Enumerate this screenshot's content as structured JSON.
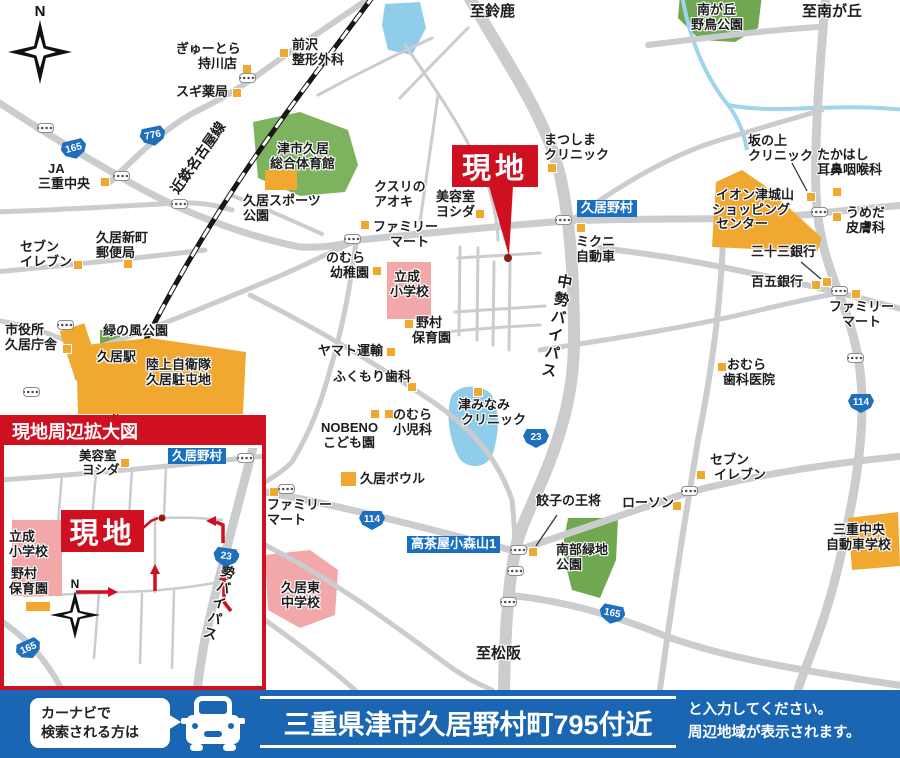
{
  "colors": {
    "site_red": "#cf1021",
    "landmark_orange": "#f0a830",
    "school_pink": "#f2a8a8",
    "park_green": "#6fa850",
    "water_blue": "#8fcdea",
    "road_gray": "#cbccce",
    "label_blue": "#1b6fbf",
    "bar_blue": "#1a66b2",
    "shield_blue": "#1e6fbc"
  },
  "compass": {
    "n": "N"
  },
  "site": {
    "label": "現地"
  },
  "roads": {
    "railway": "近鉄名古屋線",
    "bypass": "中勢バイパス"
  },
  "destinations": {
    "suzuka": "至鈴鹿",
    "minamigaoka": "至南が丘",
    "matsusaka": "至松阪"
  },
  "shields": {
    "r165": "165",
    "r776": "776",
    "r23": "23",
    "r114": "114"
  },
  "intersections": {
    "hisainomura": "久居野村",
    "takachaya": "高茶屋小森山1"
  },
  "places": {
    "gyutora": {
      "l1": "ぎゅーとら",
      "l2": "持川店"
    },
    "sugi": {
      "l1": "スギ薬局"
    },
    "ja": {
      "l1": "JA",
      "l2": "三重中央"
    },
    "maezawa": {
      "l1": "前沢",
      "l2": "整形外科"
    },
    "gym": {
      "l1": "津市久居",
      "l2": "総合体育館"
    },
    "sports_park": {
      "l1": "久居スポーツ",
      "l2": "公園"
    },
    "aoki": {
      "l1": "クスリの",
      "l2": "アオキ"
    },
    "yoshida": {
      "l1": "美容室",
      "l2": "ヨシダ"
    },
    "matsushima": {
      "l1": "まつしま",
      "l2": "クリニック"
    },
    "yacho_park": {
      "l1": "南が丘",
      "l2": "野鳥公園"
    },
    "sakanoue": {
      "l1": "坂の上",
      "l2": "クリニック"
    },
    "takahashi": {
      "l1": "たかはし",
      "l2": "耳鼻咽喉科"
    },
    "aeon": {
      "l1": "イオン津城山",
      "l2": "ショッピング",
      "l3": "センター"
    },
    "umeda": {
      "l1": "うめだ",
      "l2": "皮膚科"
    },
    "sanjusan": {
      "l1": "三十三銀行"
    },
    "hyakugo": {
      "l1": "百五銀行"
    },
    "famima_e": {
      "l1": "ファミリー",
      "l2": "マート"
    },
    "omura": {
      "l1": "おむら",
      "l2": "歯科医院"
    },
    "mikuni": {
      "l1": "ミクニ",
      "l2": "自動車"
    },
    "nomura_hoikuen": {
      "l1": "野村",
      "l2": "保育園"
    },
    "rissei": {
      "l1": "立成",
      "l2": "小学校"
    },
    "yochien": {
      "l1": "のむら",
      "l2": "幼稚園"
    },
    "famima_c": {
      "l1": "ファミリー",
      "l2": "マート"
    },
    "yamato": {
      "l1": "ヤマト運輸"
    },
    "fukumori": {
      "l1": "ふくもり歯科"
    },
    "shonika": {
      "l1": "のむら",
      "l2": "小児科"
    },
    "nobeno": {
      "l1": "NOBENO",
      "l2": "こども園"
    },
    "tsuminami": {
      "l1": "津みなみ",
      "l2": "クリニック"
    },
    "bowl": {
      "l1": "久居ボウル"
    },
    "famima_s": {
      "l1": "ファミリー",
      "l2": "マート"
    },
    "higashi_chu": {
      "l1": "久居東",
      "l2": "中学校"
    },
    "gyoza": {
      "l1": "餃子の王将"
    },
    "lawson": {
      "l1": "ローソン"
    },
    "nanbu": {
      "l1": "南部緑地",
      "l2": "公園"
    },
    "seven_e": {
      "l1": "セブン",
      "l2": "イレブン"
    },
    "driving_school": {
      "l1": "三重中央",
      "l2": "自動車学校"
    },
    "shiyakusho": {
      "l1": "市役所",
      "l2": "久居庁舎"
    },
    "midorinokaze": {
      "l1": "緑の風公園"
    },
    "station": {
      "l1": "久居駅"
    },
    "jieitai": {
      "l1": "陸上自衛隊",
      "l2": "久居駐屯地"
    },
    "seven_w": {
      "l1": "セブン",
      "l2": "イレブン"
    },
    "yubinkyoku": {
      "l1": "久居新町",
      "l2": "郵便局"
    }
  },
  "inset": {
    "title": "現地周辺拡大図"
  },
  "bottom": {
    "bubble_l1": "カーナビで",
    "bubble_l2": "検索される方は",
    "address": "三重県津市久居野村町795付近",
    "note_l1": "と入力してください。",
    "note_l2": "周辺地域が表示されます。"
  }
}
